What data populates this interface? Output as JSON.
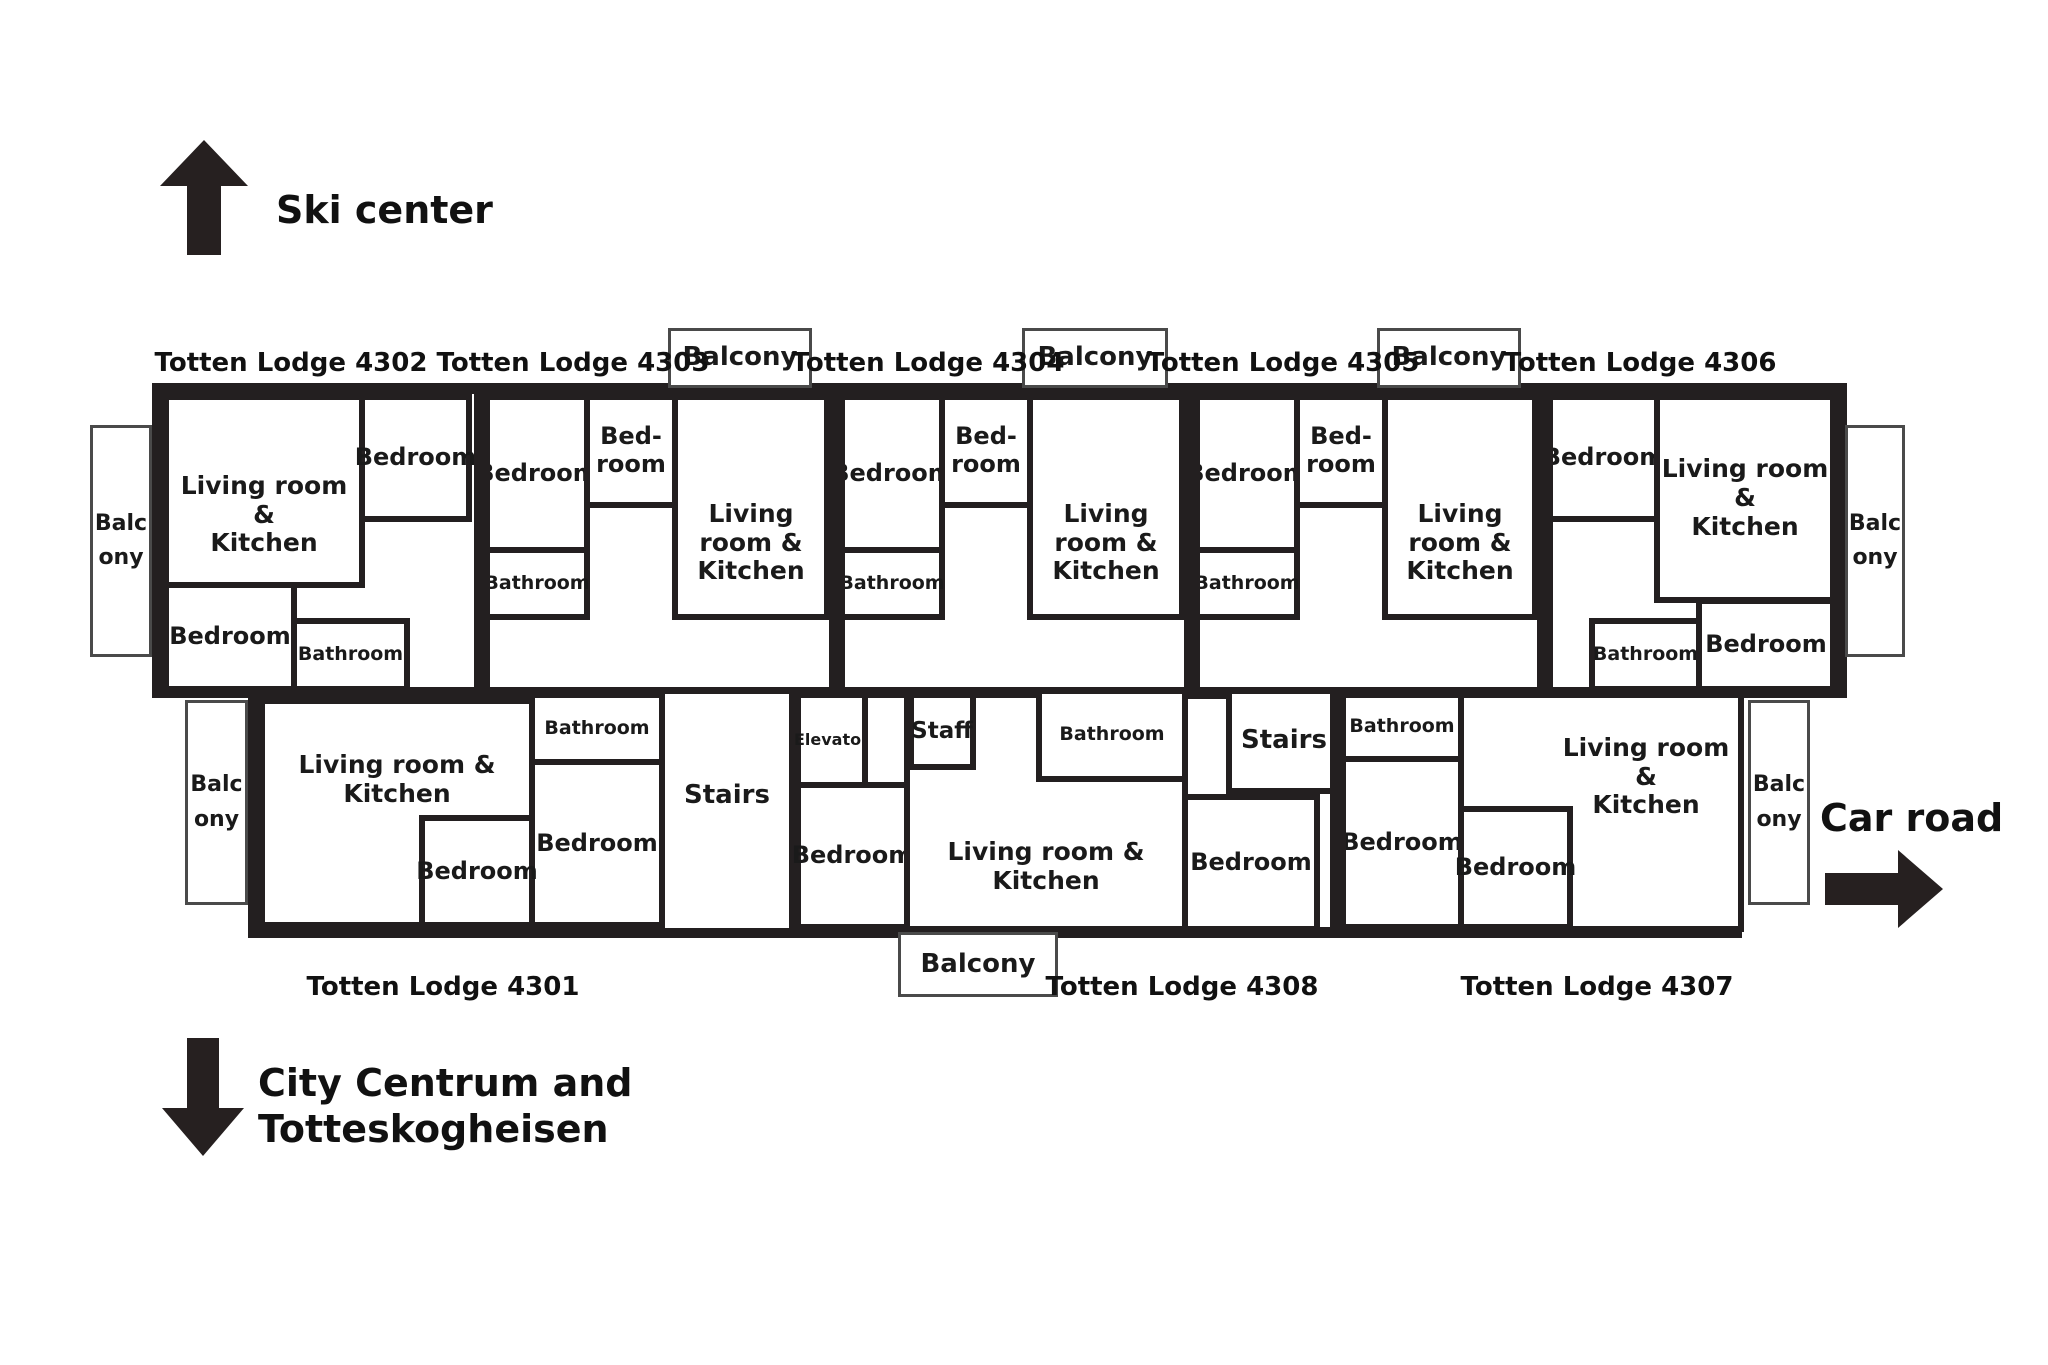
{
  "directions": {
    "ski_center": "Ski center",
    "city_centrum": "City Centrum and\nTotteskogheisen",
    "car_road": "Car road"
  },
  "lodges": {
    "l4302": "Totten Lodge 4302",
    "l4303": "Totten Lodge 4303",
    "l4304": "Totten Lodge 4304",
    "l4305": "Totten Lodge 4305",
    "l4306": "Totten Lodge 4306",
    "l4301": "Totten Lodge 4301",
    "l4308": "Totten Lodge 4308",
    "l4307": "Totten Lodge 4307"
  },
  "rooms": {
    "living": "Living room &\nKitchen",
    "bedroom": "Bedroom",
    "bedroom_split": "Bed-\nroom",
    "bathroom": "Bathroom",
    "balcony": "Balcony",
    "stairs": "Stairs",
    "elevator": "Elevator",
    "staff": "Staff"
  },
  "colors": {
    "wall": "#231f20",
    "background": "#ffffff",
    "text": "#1a1a1a",
    "arrow": "#262020"
  }
}
